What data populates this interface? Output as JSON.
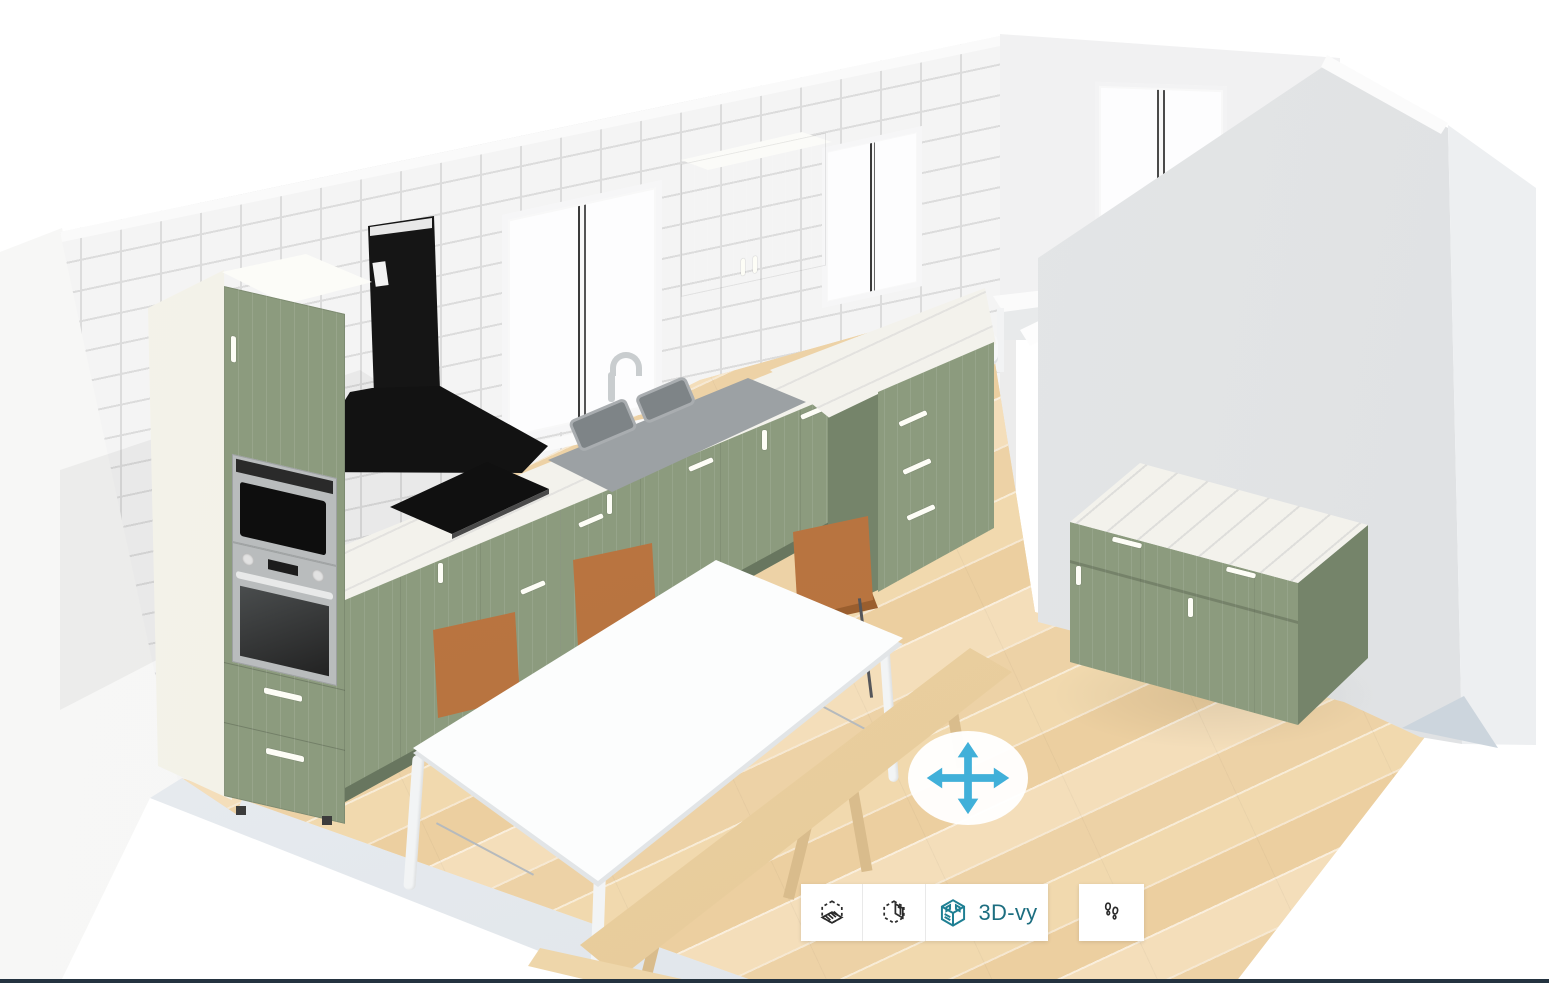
{
  "view": {
    "current": "3D-vy",
    "app": "kitchen-planner-3d-viewport"
  },
  "toolbar": {
    "view_buttons": [
      {
        "icon": "plan-view-cube-icon",
        "label": ""
      },
      {
        "icon": "elevation-view-cube-icon",
        "label": ""
      },
      {
        "icon": "3d-view-cube-icon",
        "label": "3D-vy",
        "active": true
      }
    ],
    "walk_button": {
      "icon": "footsteps-icon",
      "label": ""
    }
  },
  "pan_control": {
    "icon": "move-arrows-icon"
  },
  "colors": {
    "teal": "#1d6e80",
    "teal_icon": "#1e7f93",
    "icon_black": "#2b2b2b",
    "separator": "#e9e9e9",
    "arrow_blue": "#41b0d9",
    "bottom_bar": "#243340",
    "tile": "#f4f4f4",
    "grout": "#dcdcdc",
    "left_wall": "#f5f5f4",
    "wall_cap": "#fafafa",
    "far_wall": "#f1f1f2",
    "gray_wall": "#e3e5e6",
    "gray_wall_light": "#edeff1",
    "slab_edge": "#dfe4e9",
    "floor_base": "#f1d9ae",
    "floor_dark": "#eccfa0",
    "floor_light": "#f4deba",
    "green": "#8c9b7e",
    "green_dark": "#75846a",
    "green_deep": "#68765f",
    "cream": "#efeee3",
    "marble": "#f3f2ec",
    "counter_gray": "#9ca1a4",
    "sink_gray": "#7e8487",
    "steel": "#b9bcbd",
    "appliance_black": "#151515",
    "table_white": "#fcfdfd",
    "table_shade": "#e2e5e7",
    "chair_brown": "#b26f3c",
    "chair_brown_dark": "#9a5e2e",
    "bench_wood": "#eed6aa",
    "bench_wood_dark": "#d9bc8c",
    "glass": "#fdfdfe",
    "frame_white": "#f8f8f8"
  },
  "scene": {
    "room": {
      "walls": [
        "tiled-back-wall",
        "left-wall",
        "far-room-wall",
        "right-partition-wall"
      ],
      "floor": "light-oak-plank-floor",
      "door": "double-glass-door"
    },
    "furniture": [
      "tall-oven-cabinet",
      "wall-cabinet",
      "base-cabinet-run",
      "corner-drawer-unit",
      "kitchen-island",
      "dining-table",
      "dining-chair-1",
      "dining-chair-2",
      "dining-chair-3",
      "wood-bench-long",
      "wood-bench-short",
      "white-desk",
      "white-chair"
    ],
    "appliances": [
      "built-in-microwave",
      "built-in-oven",
      "black-chimney-hood",
      "induction-cooktop",
      "double-bowl-sink",
      "faucet"
    ]
  }
}
